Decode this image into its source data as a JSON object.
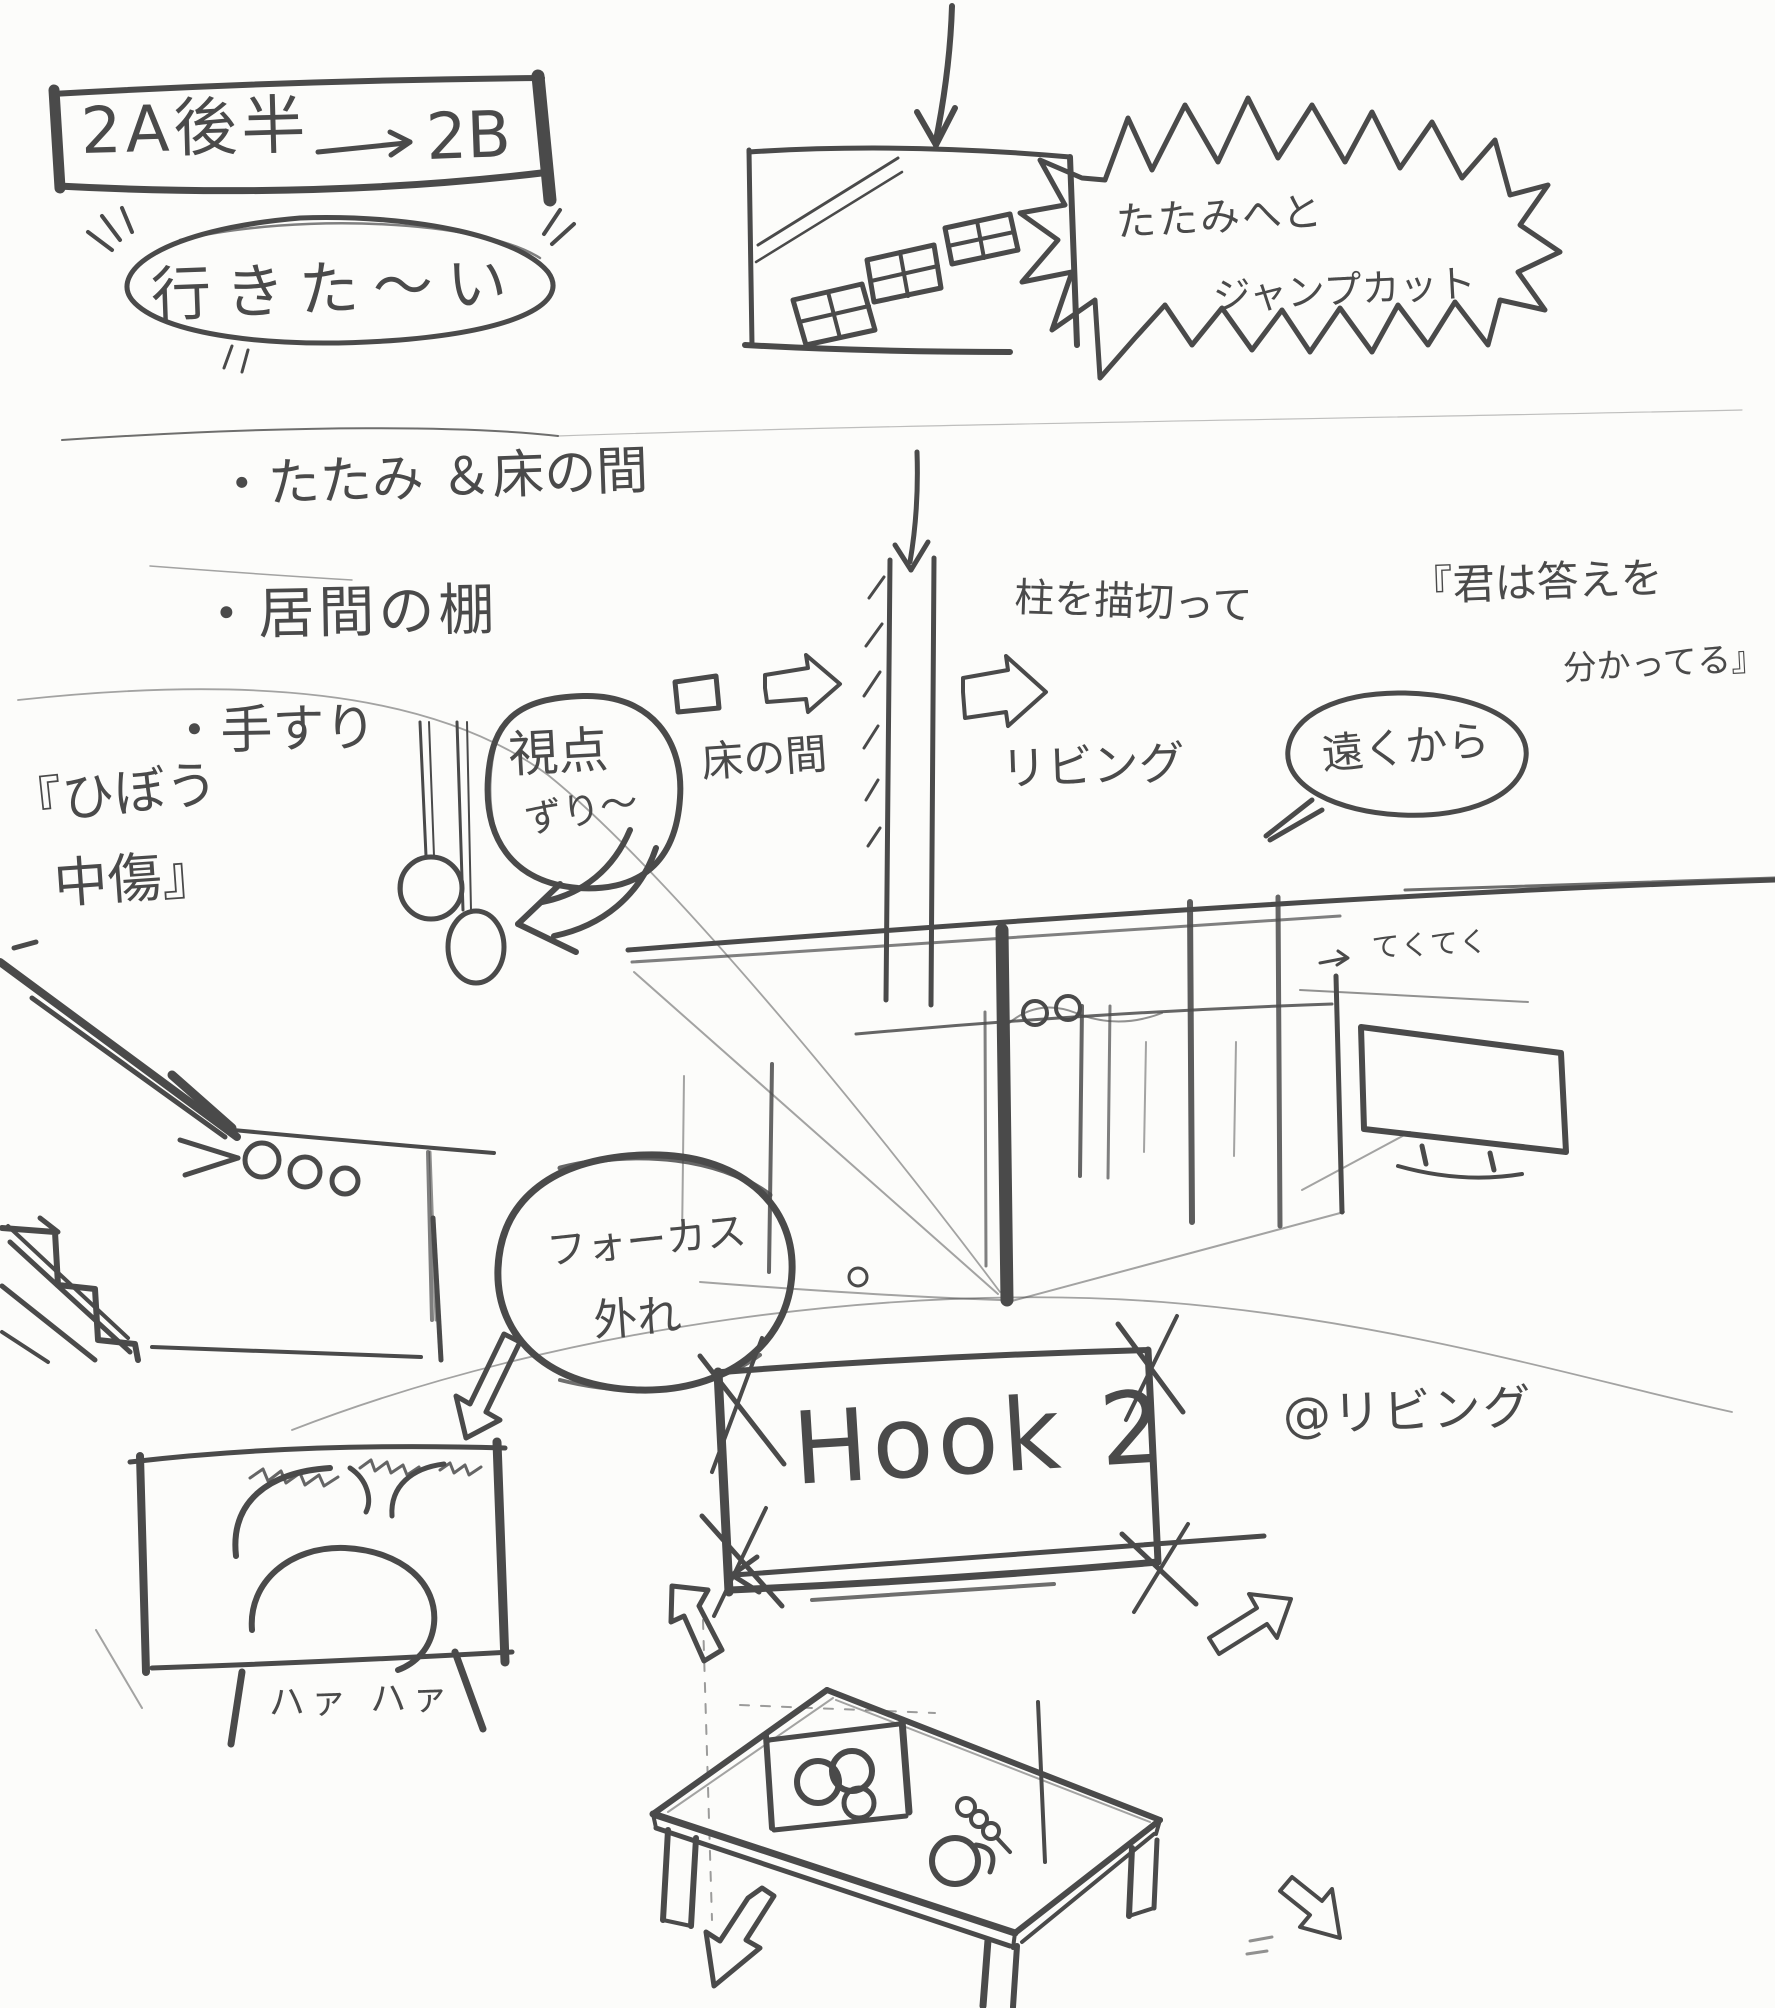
{
  "palette": {
    "ink": "#4a4a4a",
    "paper": "#fcfcfa"
  },
  "scene_header": {
    "from": "2A後半",
    "to": "2B"
  },
  "desire_bubble": {
    "text": "行きた〜い"
  },
  "jump_cut_burst": {
    "line1": "たたみへと",
    "line2": "ジャンプカット"
  },
  "checklist": {
    "items": [
      "・たたみ ＆床の間",
      "・居間の棚",
      "・手すり"
    ]
  },
  "slander_quote": {
    "line1": "『ひぼう",
    "line2": "中傷』"
  },
  "viewpoint_note": {
    "line1": "視点",
    "line2": "ずり〜"
  },
  "tokonoma": {
    "label": "床の間"
  },
  "pillar_note": {
    "label": "柱を描切って"
  },
  "living_room": {
    "label": "リビング"
  },
  "lyric_quote": {
    "line1": "『君は答えを",
    "line2": "分かってる』"
  },
  "distance_bubble": {
    "text": "遠くから"
  },
  "walking_sfx": {
    "text": "てくてく"
  },
  "focus_note": {
    "line1": "フォーカス",
    "line2": "外れ"
  },
  "panting_sfx": {
    "text": "ハァ ハァ"
  },
  "hook": {
    "title": "Hook 2",
    "location": "@リビング"
  }
}
